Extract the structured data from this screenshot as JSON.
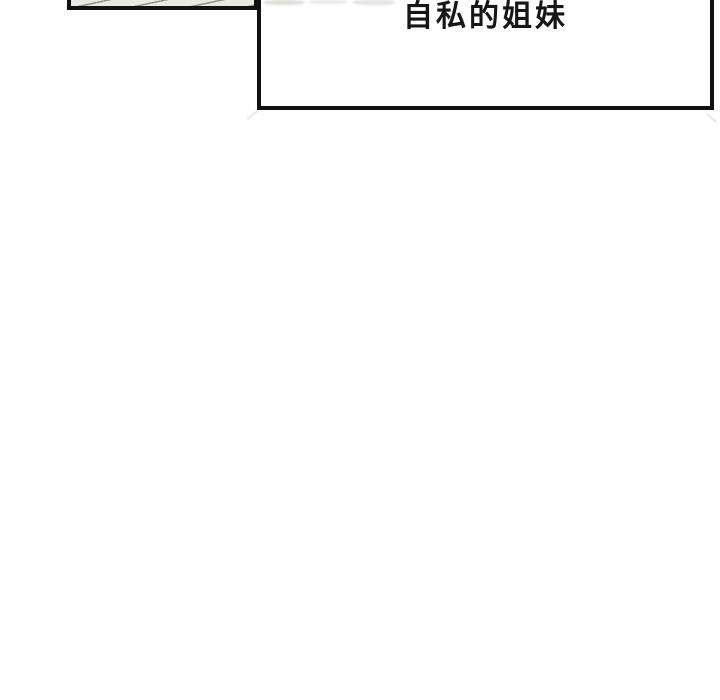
{
  "comic": {
    "caption_box": {
      "text": "自私的姐妹"
    },
    "colors": {
      "ink": "#111111",
      "paper": "#ffffff",
      "panel_fill": "#e9e8e4",
      "panel_hatch": "#8c8c86",
      "text": "#161616"
    }
  }
}
